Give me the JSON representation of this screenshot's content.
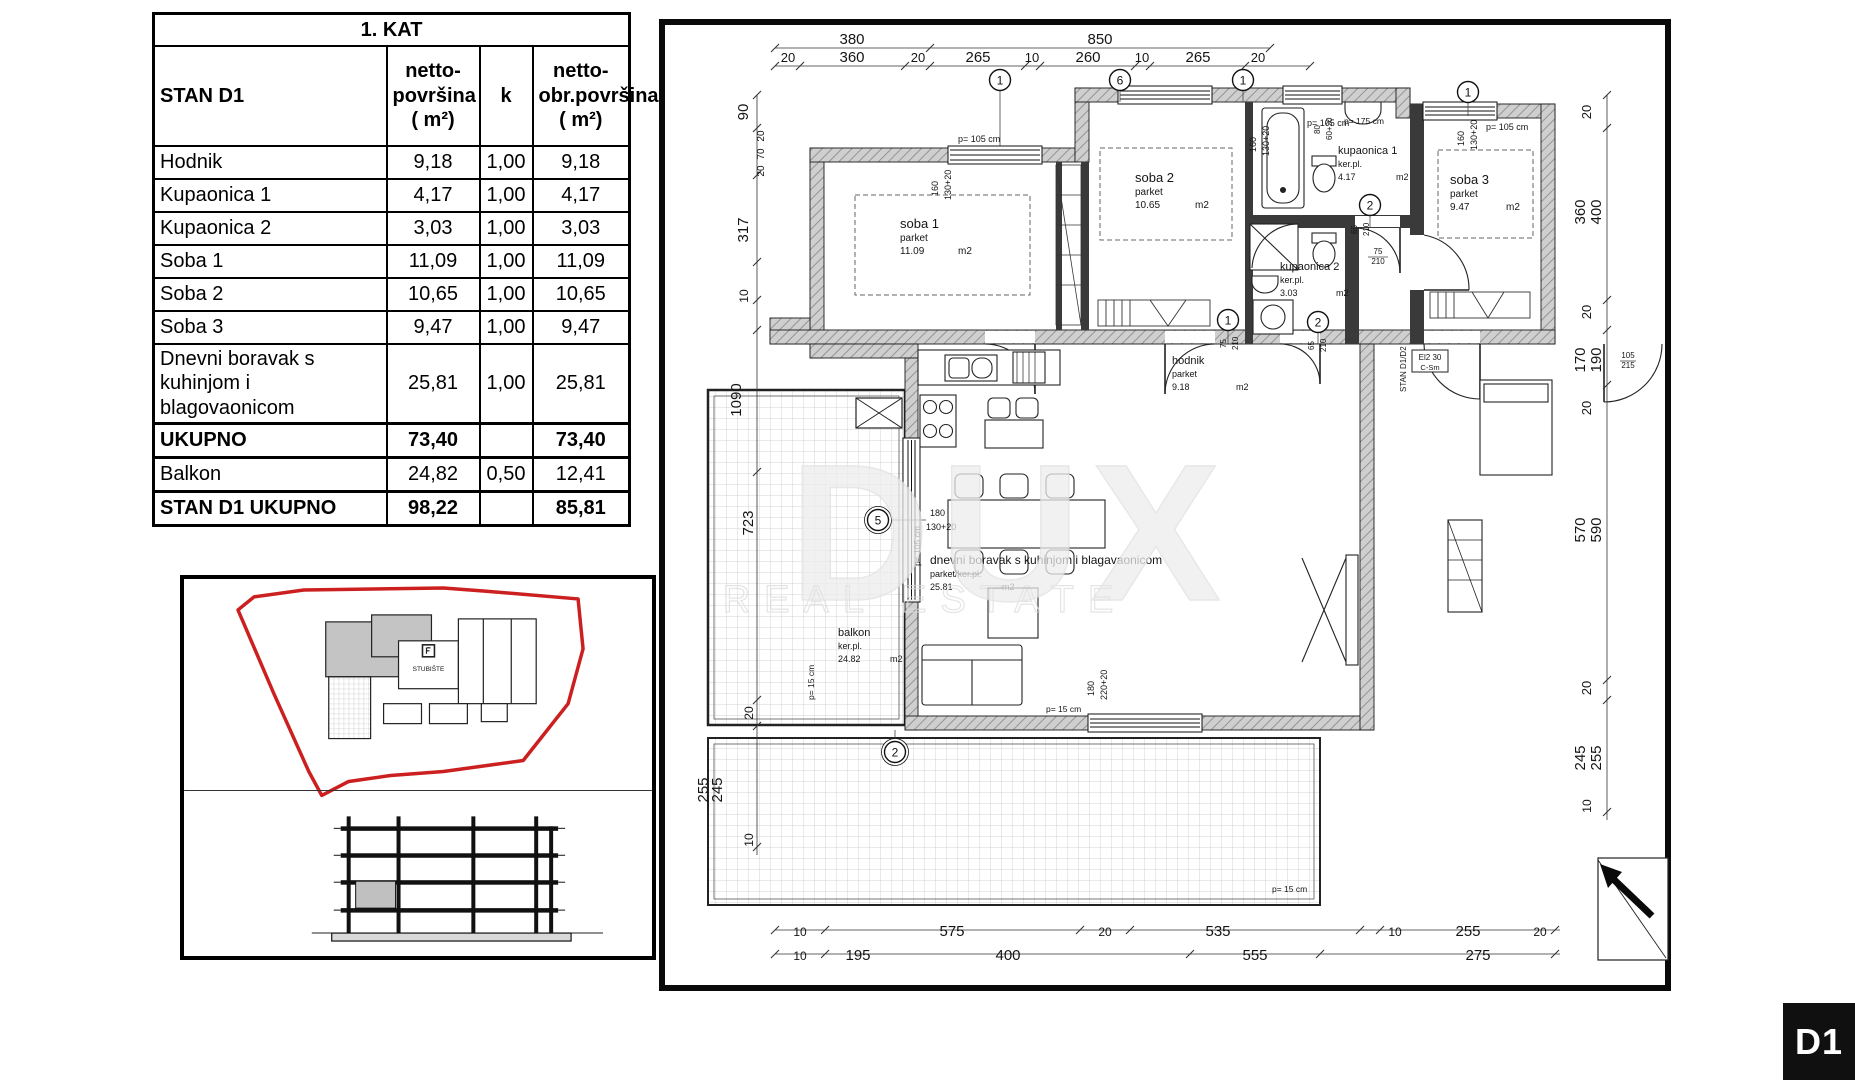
{
  "badge": {
    "label": "D1"
  },
  "table": {
    "title": "1. KAT",
    "columns": {
      "name": "STAN D1",
      "netto": "netto-\npovršina\n( m²)",
      "k": "k",
      "obr": "netto-\nobr.površina\n( m²)"
    },
    "rows": [
      {
        "name": "Hodnik",
        "netto": "9,18",
        "k": "1,00",
        "obr": "9,18"
      },
      {
        "name": "Kupaonica 1",
        "netto": "4,17",
        "k": "1,00",
        "obr": "4,17"
      },
      {
        "name": "Kupaonica 2",
        "netto": "3,03",
        "k": "1,00",
        "obr": "3,03"
      },
      {
        "name": "Soba 1",
        "netto": "11,09",
        "k": "1,00",
        "obr": "11,09"
      },
      {
        "name": "Soba 2",
        "netto": "10,65",
        "k": "1,00",
        "obr": "10,65"
      },
      {
        "name": "Soba 3",
        "netto": "9,47",
        "k": "1,00",
        "obr": "9,47"
      },
      {
        "name": "Dnevni boravak s kuhinjom i blagovaonicom",
        "netto": "25,81",
        "k": "1,00",
        "obr": "25,81"
      },
      {
        "name": "UKUPNO",
        "netto": "73,40",
        "k": "",
        "obr": "73,40",
        "bold": true,
        "thick": true
      },
      {
        "name": "Balkon",
        "netto": "24,82",
        "k": "0,50",
        "obr": "12,41"
      },
      {
        "name": "STAN D1 UKUPNO",
        "netto": "98,22",
        "k": "",
        "obr": "85,81",
        "bold": true,
        "thick": true
      }
    ]
  },
  "site": {
    "stairs_label": "STUBIŠTE"
  },
  "plan": {
    "watermark": {
      "line1": "DUX",
      "line2": "REAL ESTATE"
    },
    "rooms": [
      {
        "name": "soba 1",
        "floor": "parket",
        "area": "11.09",
        "unit": "m2",
        "x": 900,
        "y": 228,
        "ns": 13,
        "ss": 10,
        "ux": 58
      },
      {
        "name": "soba 2",
        "floor": "parket",
        "area": "10.65",
        "unit": "m2",
        "x": 1135,
        "y": 182,
        "ns": 13,
        "ss": 10,
        "ux": 60
      },
      {
        "name": "soba 3",
        "floor": "parket",
        "area": "9.47",
        "unit": "m2",
        "x": 1450,
        "y": 184,
        "ns": 13,
        "ss": 10,
        "ux": 56
      },
      {
        "name": "kupaonica 1",
        "floor": "ker.pl.",
        "area": "4.17",
        "unit": "m2",
        "x": 1338,
        "y": 154,
        "ns": 11,
        "ss": 9,
        "ux": 58
      },
      {
        "name": "kupaonica 2",
        "floor": "ker.pl.",
        "area": "3.03",
        "unit": "m2",
        "x": 1280,
        "y": 270,
        "ns": 11,
        "ss": 9,
        "ux": 56
      },
      {
        "name": "hodnik",
        "floor": "parket",
        "area": "9.18",
        "unit": "m2",
        "x": 1172,
        "y": 364,
        "ns": 11,
        "ss": 9,
        "ux": 64
      },
      {
        "name": "dnevni boravak s kuhinjom i blagavaonicom",
        "floor": "parket/ker.pl.",
        "area": "25.81",
        "unit": "m2",
        "x": 930,
        "y": 564,
        "ns": 12,
        "ss": 9,
        "ux": 72
      },
      {
        "name": "balkon",
        "floor": "ker.pl.",
        "area": "24.82",
        "unit": "m2",
        "x": 838,
        "y": 636,
        "ns": 11,
        "ss": 9,
        "ux": 52
      }
    ],
    "dims": [
      {
        "t": "380",
        "x": 852,
        "y": 44
      },
      {
        "t": "850",
        "x": 1100,
        "y": 44
      },
      {
        "t": "20",
        "x": 788,
        "y": 62,
        "s": 13
      },
      {
        "t": "360",
        "x": 852,
        "y": 62
      },
      {
        "t": "20",
        "x": 918,
        "y": 62,
        "s": 13
      },
      {
        "t": "265",
        "x": 978,
        "y": 62
      },
      {
        "t": "10",
        "x": 1032,
        "y": 62,
        "s": 13
      },
      {
        "t": "260",
        "x": 1088,
        "y": 62
      },
      {
        "t": "10",
        "x": 1142,
        "y": 62,
        "s": 13
      },
      {
        "t": "265",
        "x": 1198,
        "y": 62
      },
      {
        "t": "20",
        "x": 1258,
        "y": 62,
        "s": 13
      },
      {
        "t": "90",
        "x": 748,
        "y": 112,
        "r": -90
      },
      {
        "t": "20",
        "x": 764,
        "y": 136,
        "r": -90,
        "s": 10
      },
      {
        "t": "70",
        "x": 764,
        "y": 154,
        "r": -90,
        "s": 10
      },
      {
        "t": "20",
        "x": 764,
        "y": 171,
        "r": -90,
        "s": 10
      },
      {
        "t": "317",
        "x": 748,
        "y": 230,
        "r": -90
      },
      {
        "t": "10",
        "x": 748,
        "y": 296,
        "r": -90,
        "s": 12
      },
      {
        "t": "1090",
        "x": 741,
        "y": 400,
        "r": -90
      },
      {
        "t": "723",
        "x": 753,
        "y": 523,
        "r": -90
      },
      {
        "t": "20",
        "x": 753,
        "y": 713,
        "r": -90,
        "s": 12
      },
      {
        "t": "255",
        "x": 708,
        "y": 790,
        "r": -90
      },
      {
        "t": "245",
        "x": 722,
        "y": 790,
        "r": -90
      },
      {
        "t": "10",
        "x": 753,
        "y": 840,
        "r": -90,
        "s": 12
      },
      {
        "t": "20",
        "x": 1591,
        "y": 112,
        "r": -90,
        "s": 13
      },
      {
        "t": "360",
        "x": 1585,
        "y": 212,
        "r": -90
      },
      {
        "t": "400",
        "x": 1601,
        "y": 212,
        "r": -90
      },
      {
        "t": "20",
        "x": 1591,
        "y": 312,
        "r": -90,
        "s": 13
      },
      {
        "t": "170",
        "x": 1585,
        "y": 360,
        "r": -90
      },
      {
        "t": "190",
        "x": 1601,
        "y": 360,
        "r": -90
      },
      {
        "t": "20",
        "x": 1591,
        "y": 408,
        "r": -90,
        "s": 13
      },
      {
        "t": "570",
        "x": 1585,
        "y": 530,
        "r": -90
      },
      {
        "t": "590",
        "x": 1601,
        "y": 530,
        "r": -90
      },
      {
        "t": "20",
        "x": 1591,
        "y": 688,
        "r": -90,
        "s": 13
      },
      {
        "t": "245",
        "x": 1585,
        "y": 758,
        "r": -90
      },
      {
        "t": "255",
        "x": 1601,
        "y": 758,
        "r": -90
      },
      {
        "t": "10",
        "x": 1591,
        "y": 806,
        "r": -90,
        "s": 12
      },
      {
        "t": "10",
        "x": 800,
        "y": 936,
        "s": 12
      },
      {
        "t": "575",
        "x": 952,
        "y": 936
      },
      {
        "t": "20",
        "x": 1105,
        "y": 936,
        "s": 12
      },
      {
        "t": "535",
        "x": 1218,
        "y": 936
      },
      {
        "t": "10",
        "x": 1395,
        "y": 936,
        "s": 12
      },
      {
        "t": "255",
        "x": 1468,
        "y": 936
      },
      {
        "t": "20",
        "x": 1540,
        "y": 936,
        "s": 12
      },
      {
        "t": "10",
        "x": 800,
        "y": 960,
        "s": 12
      },
      {
        "t": "195",
        "x": 858,
        "y": 960
      },
      {
        "t": "400",
        "x": 1008,
        "y": 960
      },
      {
        "t": "555",
        "x": 1255,
        "y": 960
      },
      {
        "t": "275",
        "x": 1478,
        "y": 960
      }
    ],
    "notes": [
      {
        "t": "p= 105 cm",
        "x": 958,
        "y": 142
      },
      {
        "t": "160",
        "x": 938,
        "y": 196,
        "r": -90
      },
      {
        "t": "130+20",
        "x": 951,
        "y": 200,
        "r": -90
      },
      {
        "t": "p= 105 cm",
        "x": 1307,
        "y": 126
      },
      {
        "t": "160",
        "x": 1256,
        "y": 152,
        "r": -90
      },
      {
        "t": "130+20",
        "x": 1269,
        "y": 156,
        "r": -90
      },
      {
        "t": "80",
        "x": 1320,
        "y": 134,
        "r": -90,
        "s": 8
      },
      {
        "t": "60+20",
        "x": 1332,
        "y": 140,
        "r": -90,
        "s": 8
      },
      {
        "t": "p= 175 cm",
        "x": 1344,
        "y": 124,
        "s": 8.5
      },
      {
        "t": "p= 105 cm",
        "x": 1486,
        "y": 130
      },
      {
        "t": "160",
        "x": 1464,
        "y": 146,
        "r": -90
      },
      {
        "t": "130+20",
        "x": 1477,
        "y": 150,
        "r": -90
      },
      {
        "t": "180",
        "x": 930,
        "y": 516
      },
      {
        "t": "130+20",
        "x": 926,
        "y": 530
      },
      {
        "t": "p= 105 cm",
        "x": 920,
        "y": 566,
        "r": -90,
        "s": 8.5
      },
      {
        "t": "65",
        "x": 1357,
        "y": 234,
        "r": -90,
        "s": 8
      },
      {
        "t": "210",
        "x": 1369,
        "y": 236,
        "r": -90,
        "s": 8
      },
      {
        "t": "75",
        "x": 1378,
        "y": 254,
        "s": 8,
        "a": "m"
      },
      {
        "t": "210",
        "x": 1378,
        "y": 264,
        "s": 8,
        "a": "m"
      },
      {
        "t": "75",
        "x": 1226,
        "y": 348,
        "r": -90,
        "s": 8
      },
      {
        "t": "210",
        "x": 1238,
        "y": 350,
        "r": -90,
        "s": 8
      },
      {
        "t": "65",
        "x": 1314,
        "y": 350,
        "r": -90,
        "s": 8
      },
      {
        "t": "210",
        "x": 1326,
        "y": 352,
        "r": -90,
        "s": 8
      },
      {
        "t": "180",
        "x": 1094,
        "y": 696,
        "r": -90
      },
      {
        "t": "220+20",
        "x": 1107,
        "y": 700,
        "r": -90
      },
      {
        "t": "p= 15 cm",
        "x": 1046,
        "y": 712,
        "s": 8.5
      },
      {
        "t": "p= 15 cm",
        "x": 814,
        "y": 700,
        "r": -90,
        "s": 8.5
      },
      {
        "t": "p= 15 cm",
        "x": 1272,
        "y": 892,
        "s": 8.5
      },
      {
        "t": "STAN D1/D2",
        "x": 1406,
        "y": 392,
        "r": -90,
        "s": 8
      },
      {
        "t": "El2 30",
        "x": 1430,
        "y": 360,
        "s": 8,
        "a": "m"
      },
      {
        "t": "C-Sm",
        "x": 1430,
        "y": 370,
        "s": 7.5,
        "a": "m"
      },
      {
        "t": "105",
        "x": 1628,
        "y": 358,
        "s": 8,
        "a": "m"
      },
      {
        "t": "215",
        "x": 1628,
        "y": 368,
        "s": 8,
        "a": "m"
      }
    ],
    "circles": [
      {
        "n": "1",
        "x": 1000,
        "y": 80
      },
      {
        "n": "6",
        "x": 1120,
        "y": 80
      },
      {
        "n": "1",
        "x": 1243,
        "y": 80
      },
      {
        "n": "1",
        "x": 1468,
        "y": 92
      },
      {
        "n": "2",
        "x": 1370,
        "y": 205
      },
      {
        "n": "1",
        "x": 1228,
        "y": 320
      },
      {
        "n": "2",
        "x": 1318,
        "y": 322
      },
      {
        "n": "5",
        "x": 878,
        "y": 520,
        "d": true
      },
      {
        "n": "2",
        "x": 895,
        "y": 752,
        "d": true
      }
    ]
  }
}
